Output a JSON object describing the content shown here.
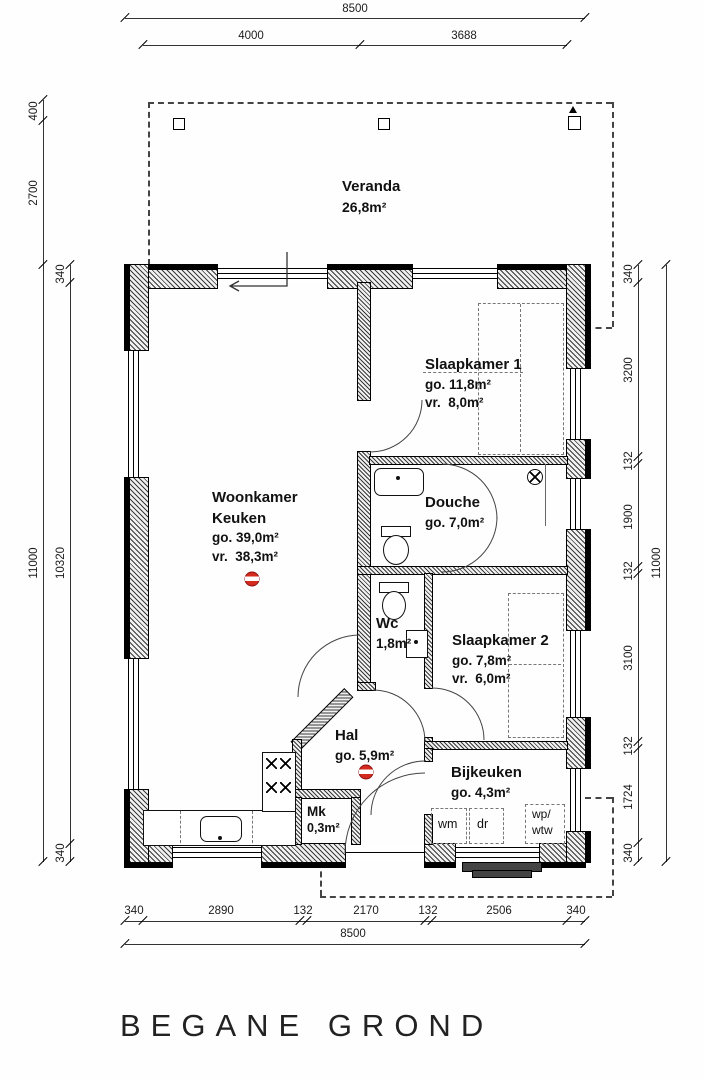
{
  "title": "BEGANE GROND",
  "colors": {
    "detector_red": "#d42b1e",
    "wall": "#000000"
  },
  "rooms": {
    "veranda": {
      "name": "Veranda",
      "area": "26,8m²"
    },
    "slaapkamer1": {
      "name": "Slaapkamer 1",
      "go": "go. 11,8m²",
      "vr": "vr.  8,0m²"
    },
    "woonkamer": {
      "name1": "Woonkamer",
      "name2": "Keuken",
      "go": "go. 39,0m²",
      "vr": "vr.  38,3m²"
    },
    "douche": {
      "name": "Douche",
      "go": "go. 7,0m²"
    },
    "wc": {
      "name": "Wc",
      "area": "1,8m²"
    },
    "slaapkamer2": {
      "name": "Slaapkamer 2",
      "go": "go. 7,8m²",
      "vr": "vr.  6,0m²"
    },
    "hal": {
      "name": "Hal",
      "go": "go. 5,9m²"
    },
    "bijkeuken": {
      "name": "Bijkeuken",
      "go": "go. 4,3m²"
    },
    "mk": {
      "name": "Mk",
      "area": "0,3m²"
    }
  },
  "appliances": {
    "wm": "wm",
    "dr": "dr",
    "wp_line1": "wp/",
    "wp_line2": "wtw"
  },
  "dimensions": {
    "top": {
      "overall": "8500",
      "segments": [
        "4000",
        "3688"
      ]
    },
    "bottom": {
      "overall": "8500",
      "segments": [
        "340",
        "2890",
        "132",
        "2170",
        "132",
        "2506",
        "340"
      ]
    },
    "left": {
      "overall": "11000",
      "veranda": [
        "400",
        "2700"
      ],
      "segments": [
        "340",
        "10320",
        "340"
      ]
    },
    "right": {
      "overall": "11000",
      "segments": [
        "340",
        "3200",
        "132",
        "1900",
        "132",
        "3100",
        "132",
        "1724",
        "340"
      ]
    }
  }
}
